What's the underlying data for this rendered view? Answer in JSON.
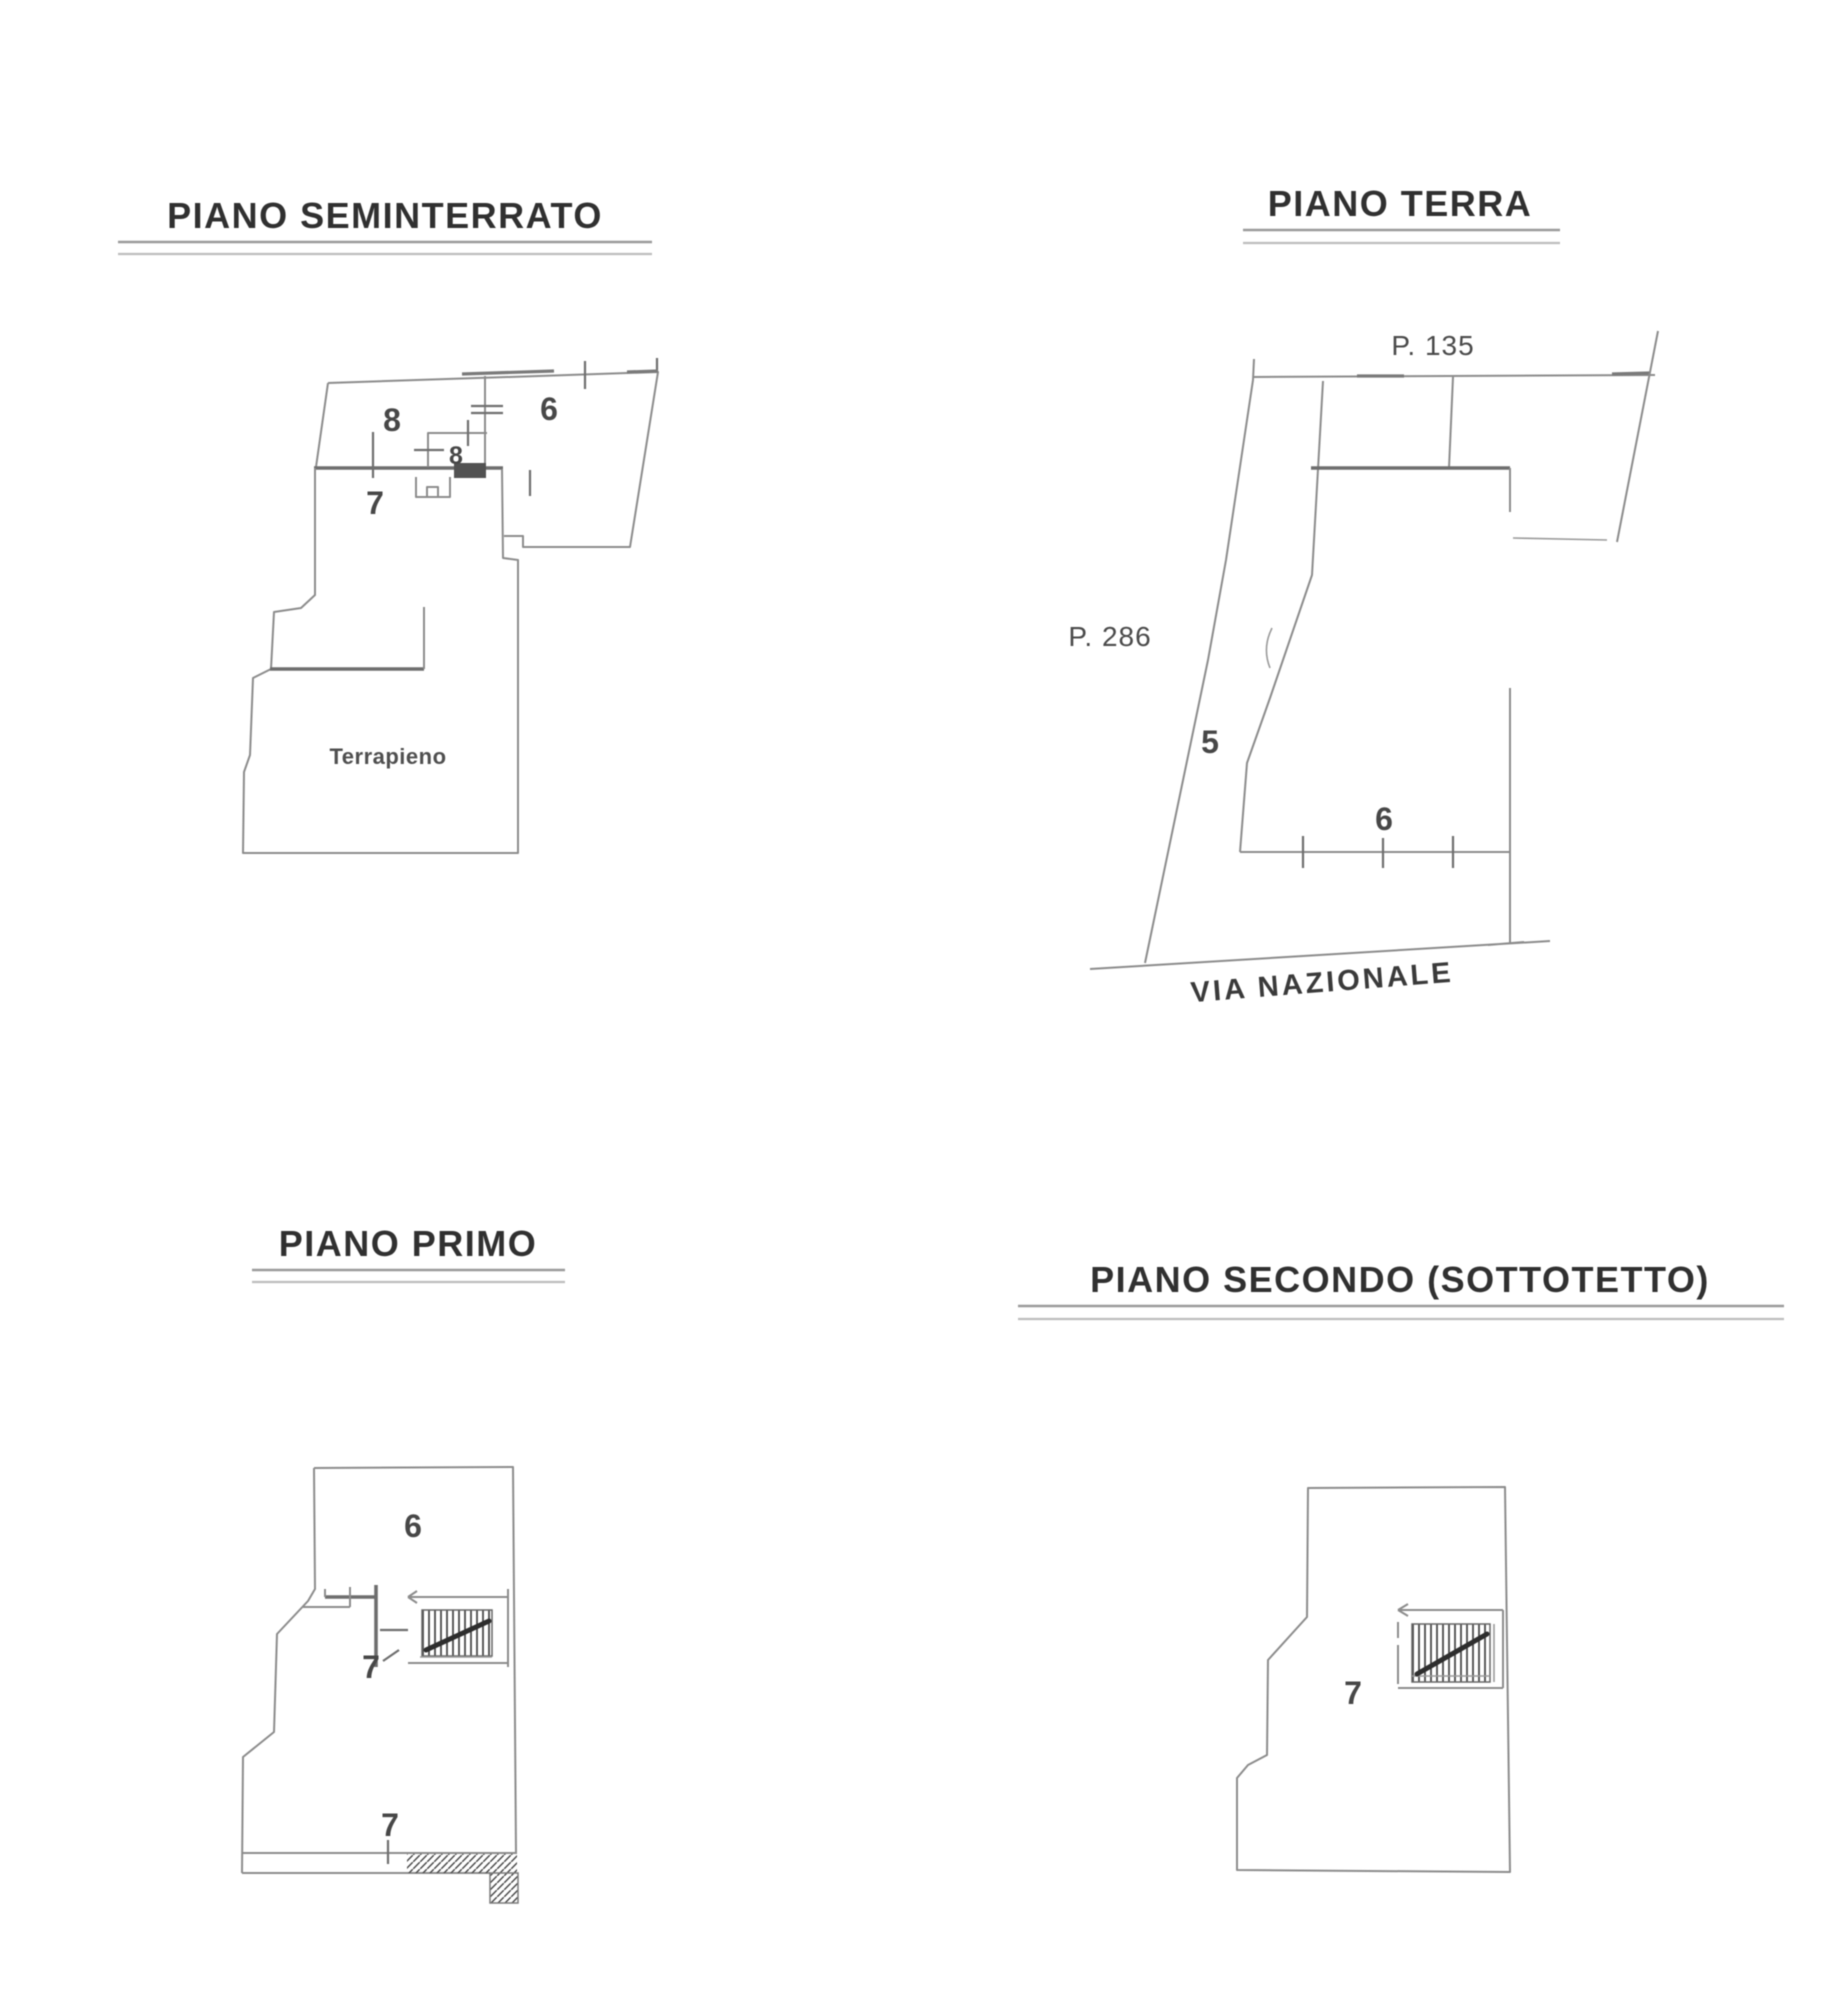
{
  "page": {
    "background": "#ffffff",
    "ink": "#3f3f3f",
    "line_color": "#8c8c8c",
    "wall_color": "#6e6e6e"
  },
  "plans": {
    "seminterrato": {
      "title": "PIANO SEMINTERRATO",
      "room8": "8",
      "stair_room8": "8",
      "room6": "6",
      "room7": "7",
      "terrain_label": "Terrapieno"
    },
    "terra": {
      "title": "PIANO TERRA",
      "parcel_top": "P. 135",
      "parcel_left": "P. 286",
      "area5": "5",
      "area6": "6",
      "street": "VIA NAZIONALE"
    },
    "primo": {
      "title": "PIANO PRIMO",
      "room6": "6",
      "room7_upper": "7",
      "room7_lower": "7"
    },
    "secondo": {
      "title": "PIANO SECONDO (SOTTOTETTO)",
      "room7": "7"
    }
  }
}
